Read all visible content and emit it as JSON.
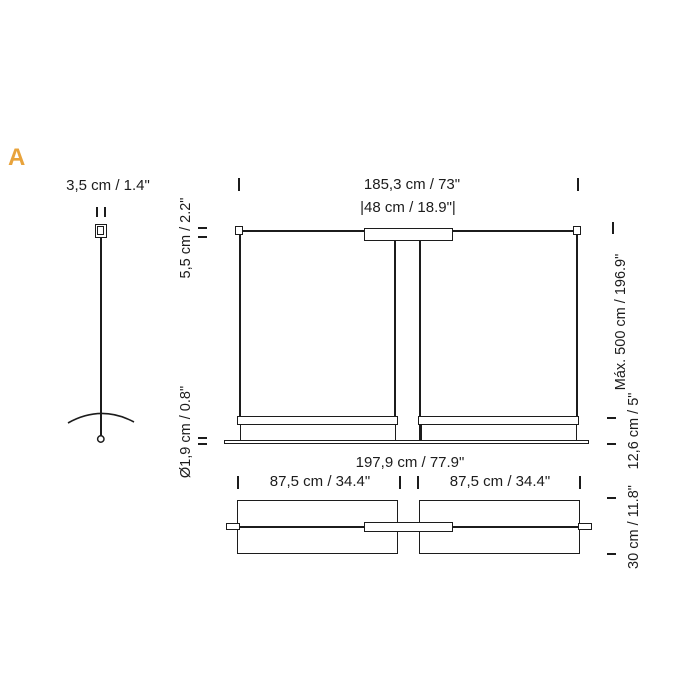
{
  "accent_color": "#E8A33C",
  "ink_color": "#1C1C1C",
  "section_label": "A",
  "labels": {
    "cable_width": "3,5 cm / 1.4\"",
    "overall_width": "185,3 cm / 73\"",
    "canopy_width": "|48 cm / 18.9\"|",
    "canopy_height": "5,5 cm / 2.2\"",
    "rod_diameter": "Ø1,9 cm / 0.8\"",
    "diffuser_width": "197,9 cm / 77.9\"",
    "max_height": "Máx. 500 cm / 196.9\"",
    "bar_height": "12,6 cm / 5\"",
    "panel_left_width": "87,5 cm / 34.4\"",
    "panel_right_width": "87,5 cm / 34.4\"",
    "depth": "30 cm / 11.8\""
  }
}
